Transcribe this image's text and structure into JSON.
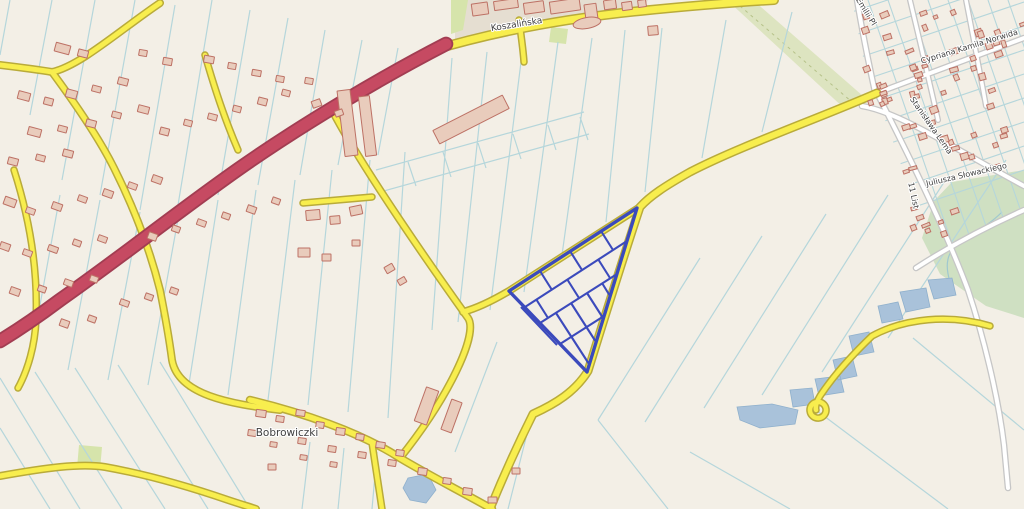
{
  "map": {
    "width": 1024,
    "height": 509,
    "colors": {
      "background": "#f3efe6",
      "field_line": "#b5d6db",
      "urban_fill": "#e5ded1",
      "building_fill": "#e9ccbc",
      "building_stroke": "#bd7165",
      "water_fill": "#a9c2da",
      "water_stroke": "#8fb0cc",
      "parcel_blue": "#3b4abc",
      "label_color": "#3f3f3f",
      "stream": "#9fc8cf",
      "tree_row_dash": "#b6c289"
    },
    "road_classes": {
      "white": {
        "casing": "#c6c6c6",
        "fill": "#ffffff",
        "extra": 2.6
      },
      "yellow": {
        "casing": "#b9ab3a",
        "fill": "#f8ee4e",
        "extra": 3.0
      },
      "red": {
        "casing": "#a23d52",
        "fill": "#c64a62",
        "extra": 3.6
      }
    },
    "labels": [
      {
        "name": "street-label-koszalinska",
        "text": "Koszalińska",
        "x": 517,
        "y": 27,
        "rot": -9,
        "size": 9
      },
      {
        "name": "place-label-bobrowiczki",
        "text": "Bobrowiczki",
        "x": 287,
        "y": 436,
        "rot": 0,
        "size": 10.5
      },
      {
        "name": "street-label-norwida",
        "text": "Cypriana Kamila Norwida",
        "x": 970,
        "y": 49,
        "rot": -17,
        "size": 8
      },
      {
        "name": "street-label-lema",
        "text": "Stanisława Lema",
        "x": 929,
        "y": 127,
        "rot": 55,
        "size": 8
      },
      {
        "name": "street-label-11-listopada",
        "text": "11 List",
        "x": 911,
        "y": 196,
        "rot": 78,
        "size": 8
      },
      {
        "name": "street-label-slowackiego",
        "text": "Juliusza Słowackiego",
        "x": 967,
        "y": 177,
        "rot": -13,
        "size": 8
      },
      {
        "name": "street-label-emilii",
        "text": "Emilii Pl",
        "x": 864,
        "y": 13,
        "rot": 58,
        "size": 8
      }
    ],
    "areas": [
      {
        "name": "urban-block",
        "fill": "#e5ded1",
        "d": "M 455,42 L 455,0 L 648,0 L 642,12 L 540,27 Z"
      },
      {
        "name": "tree-band",
        "fill": "#dde4c0",
        "d": "M 727,0 L 753,0 L 863,96 L 846,110 Z"
      },
      {
        "name": "meadow-large",
        "fill": "#cfe0c2",
        "d": "M 952,182 L 1024,170 L 1024,318 L 986,306 L 940,274 L 922,238 L 934,201 Z"
      },
      {
        "name": "green-strip-a",
        "fill": "#d6e4ab",
        "d": "M 451,0 L 468,0 L 463,30 L 451,34 Z"
      },
      {
        "name": "green-patch-b",
        "fill": "#d6e4ab",
        "d": "M 551,27 L 568,29 L 566,44 L 549,42 Z"
      },
      {
        "name": "green-patch-c",
        "fill": "#d6e4ab",
        "d": "M 79,445 L 102,447 L 100,470 L 77,468 Z"
      }
    ],
    "tree_row_dash_d": "M 740,6 L 852,102",
    "stream_d": "M 1002,212 C 982,232 962,236 952,250 C 945,260 947,272 950,282",
    "field_lines": [
      "M 10,0 L 0,55",
      "M 52,0 L 30,115",
      "M 95,0 L 62,180",
      "M 135,0 L 100,195",
      "M 175,5 L 140,210",
      "M 212,0 L 178,205",
      "M 250,10 L 218,195",
      "M 288,18 L 258,185",
      "M 325,30 L 300,175",
      "M 362,40 L 338,165",
      "M 398,48 L 378,155",
      "M 60,195 L 30,360",
      "M 100,200 L 68,370",
      "M 140,212 L 108,380",
      "M 180,208 L 148,385",
      "M 218,200 L 188,390",
      "M 256,190 L 228,395",
      "M 295,180 L 268,400",
      "M 332,170 L 308,405",
      "M 370,160 L 348,412",
      "M 405,152 L 388,418",
      "M 0,378 L 80,509",
      "M 0,428 L 50,509",
      "M 35,372 L 122,509",
      "M 75,368 L 165,509",
      "M 118,365 L 208,509",
      "M 160,362 L 250,509",
      "M 452,58 L 432,330",
      "M 487,52 L 458,322",
      "M 523,46 L 490,310",
      "M 558,42 L 524,292",
      "M 592,38 L 562,255",
      "M 625,30 L 606,222",
      "M 376,170 L 584,112",
      "M 380,192 L 589,134",
      "M 408,162 L 416,186",
      "M 443,152 L 451,177",
      "M 478,143 L 486,168",
      "M 513,134 L 521,159",
      "M 548,125 L 556,150",
      "M 580,117 L 588,140",
      "M 662,28 L 645,192",
      "M 726,20 L 702,158",
      "M 792,12 L 762,132",
      "M 700,258 L 598,420",
      "M 762,236 L 645,422",
      "M 826,214 L 704,408",
      "M 888,195 L 762,395",
      "M 948,176 L 822,372",
      "M 1006,160 L 888,338",
      "M 913,338 L 1024,430",
      "M 800,398 L 948,509",
      "M 690,452 L 790,509",
      "M 598,420 L 668,509",
      "M 497,342 L 455,452",
      "M 528,430 L 508,509",
      "M 310,442 L 302,509",
      "M 344,448 L 338,509",
      "M 377,452 L 372,509"
    ],
    "residential_grid": {
      "clip": "M 852,0 L 1024,0 L 1024,205 L 934,262 L 896,150 L 864,62 Z",
      "lines": [
        "M 852,12 L 1024,-46",
        "M 852,36 L 1024,-22",
        "M 852,60 L 1024,2",
        "M 852,84 L 1024,26",
        "M 852,108 L 1024,50",
        "M 852,132 L 1024,74",
        "M 852,156 L 1024,98",
        "M 852,180 L 1024,122",
        "M 852,204 L 1024,146",
        "M 852,228 L 1024,170",
        "M 868,0 L 956,255",
        "M 888,0 L 976,255",
        "M 908,0 L 996,255",
        "M 928,0 L 1016,255",
        "M 948,0 L 1036,255",
        "M 968,0 L 1056,255",
        "M 988,0 L 1076,255",
        "M 1008,0 L 1096,255"
      ]
    },
    "water": [
      "M 928,280 L 952,278 L 956,295 L 934,299 Z",
      "M 900,292 L 926,288 L 930,307 L 906,312 Z",
      "M 878,306 L 898,302 L 903,319 L 882,323 Z",
      "M 849,336 L 869,332 L 874,352 L 854,356 Z",
      "M 833,360 L 852,356 L 857,376 L 838,380 Z",
      "M 815,379 L 840,376 L 844,392 L 819,396 Z",
      "M 790,390 L 812,388 L 815,404 L 793,407 Z",
      "M 737,407 L 772,404 L 798,410 L 795,424 L 760,428 L 740,420 Z",
      "M 408,478 L 428,474 L 436,490 L 426,503 L 410,500 L 403,488 Z"
    ],
    "roads": [
      {
        "name": "street-emilii-road",
        "cls": "white",
        "w": 4,
        "d": "M 857,0 C 862,30 868,60 875,92"
      },
      {
        "name": "street-11-listopada-road",
        "cls": "white",
        "w": 4,
        "d": "M 877,93 C 905,148 945,228 968,290 C 983,335 998,395 1004,445 L 1008,488"
      },
      {
        "name": "street-norwida-road",
        "cls": "white",
        "w": 4,
        "d": "M 877,93 L 1024,38"
      },
      {
        "name": "street-upper-diagonal",
        "cls": "white",
        "w": 4,
        "d": "M 862,106 C 900,112 960,152 1024,186"
      },
      {
        "name": "street-slowackiego-road",
        "cls": "white",
        "w": 4,
        "d": "M 916,268 C 950,246 988,226 1024,210"
      },
      {
        "name": "street-grid-a",
        "cls": "white",
        "w": 3.5,
        "d": "M 910,0 C 920,42 930,84 938,120"
      },
      {
        "name": "street-grid-b",
        "cls": "white",
        "w": 3.5,
        "d": "M 966,0 C 973,36 980,72 986,106"
      },
      {
        "name": "road-koszalinska",
        "cls": "yellow",
        "w": 7,
        "d": "M 430,51 C 490,33 560,19 640,11 C 690,6 740,2 774,0"
      },
      {
        "name": "road-main-east",
        "cls": "yellow",
        "w": 6,
        "d": "M 877,93 C 820,118 740,146 690,172 C 665,186 650,196 640,207 C 628,243 610,300 588,371 C 575,392 555,404 533,414 C 520,440 505,472 490,509"
      },
      {
        "name": "road-parcel-northwest",
        "cls": "yellow",
        "w": 5,
        "d": "M 640,207 L 509,291 C 492,301 478,308 463,312"
      },
      {
        "name": "road-center-diagonal",
        "cls": "yellow",
        "w": 5,
        "d": "M 332,110 C 362,168 435,272 468,318 C 479,334 448,398 400,458"
      },
      {
        "name": "road-bobrowiczki",
        "cls": "yellow",
        "w": 5.5,
        "d": "M 250,400 C 300,412 360,432 400,458 C 425,473 458,490 492,509"
      },
      {
        "name": "road-southwest",
        "cls": "yellow",
        "w": 5,
        "d": "M 0,476 C 45,468 80,463 105,467 C 150,475 190,487 228,500 C 240,504 250,507 256,509"
      },
      {
        "name": "road-northwest-fork",
        "cls": "yellow",
        "w": 5,
        "d": "M 0,65 C 25,68 40,70 52,72 C 80,66 120,30 160,3"
      },
      {
        "name": "road-village-vertical",
        "cls": "yellow",
        "w": 5,
        "d": "M 52,72 C 80,110 100,140 114,168 C 135,210 150,250 160,290 C 166,320 170,345 172,360 C 178,395 230,404 280,410"
      },
      {
        "name": "road-far-west",
        "cls": "yellow",
        "w": 4.5,
        "d": "M 14,170 C 30,220 38,270 36,320 C 35,345 28,370 18,388"
      },
      {
        "name": "road-spur",
        "cls": "yellow",
        "w": 4.5,
        "d": "M 303,203 L 372,197"
      },
      {
        "name": "road-small-north",
        "cls": "yellow",
        "w": 4.5,
        "d": "M 205,55 C 215,90 225,120 238,150"
      },
      {
        "name": "road-bottom-stub",
        "cls": "yellow",
        "w": 4.5,
        "d": "M 372,443 L 382,509"
      },
      {
        "name": "road-koszalinska-stub",
        "cls": "yellow",
        "w": 4.5,
        "d": "M 519,20 C 521,35 523,48 524,62"
      },
      {
        "name": "road-pond-lane",
        "cls": "yellow",
        "w": 4.5,
        "d": "M 990,326 C 950,314 905,318 872,336 C 850,357 832,378 820,396 C 817,401 815,406 816,410 M 826,409 a 8,8 0 1,1 -16,2 a 8,8 0 1,1 16,-2"
      },
      {
        "name": "road-trunk",
        "cls": "red",
        "w": 11,
        "d": "M 446,44 C 380,78 300,126 240,168 C 180,210 120,258 60,300 C 40,315 18,330 0,341"
      }
    ],
    "buildings": {
      "rects": [
        [
          472,
          3,
          16,
          12,
          -8
        ],
        [
          494,
          0,
          24,
          9,
          -8
        ],
        [
          524,
          2,
          20,
          11,
          -8
        ],
        [
          550,
          0,
          30,
          12,
          -8
        ],
        [
          585,
          4,
          12,
          16,
          -8
        ],
        [
          604,
          0,
          12,
          9,
          -8
        ],
        [
          622,
          2,
          10,
          8,
          -8
        ],
        [
          638,
          0,
          8,
          7,
          -8
        ],
        [
          648,
          26,
          10,
          9,
          -5
        ],
        [
          341,
          90,
          13,
          66,
          -7
        ],
        [
          362,
          96,
          11,
          60,
          -7
        ],
        [
          432,
          112,
          78,
          15,
          -27
        ],
        [
          306,
          210,
          14,
          10,
          -5
        ],
        [
          330,
          216,
          10,
          8,
          -5
        ],
        [
          350,
          206,
          12,
          9,
          -12
        ],
        [
          298,
          248,
          12,
          9,
          0
        ],
        [
          322,
          254,
          9,
          7,
          0
        ],
        [
          352,
          240,
          8,
          6,
          0
        ],
        [
          385,
          265,
          9,
          7,
          -30
        ],
        [
          398,
          278,
          8,
          6,
          -30
        ],
        [
          55,
          44,
          15,
          9,
          15
        ],
        [
          78,
          50,
          10,
          7,
          15
        ],
        [
          18,
          92,
          12,
          8,
          15
        ],
        [
          44,
          98,
          9,
          7,
          15
        ],
        [
          66,
          90,
          11,
          8,
          15
        ],
        [
          92,
          86,
          9,
          6,
          15
        ],
        [
          118,
          78,
          10,
          7,
          15
        ],
        [
          28,
          128,
          13,
          8,
          15
        ],
        [
          58,
          126,
          9,
          6,
          15
        ],
        [
          86,
          120,
          10,
          7,
          15
        ],
        [
          112,
          112,
          9,
          6,
          15
        ],
        [
          138,
          106,
          11,
          7,
          15
        ],
        [
          8,
          158,
          10,
          7,
          15
        ],
        [
          36,
          155,
          9,
          6,
          15
        ],
        [
          63,
          150,
          10,
          7,
          15
        ],
        [
          160,
          128,
          9,
          7,
          15
        ],
        [
          184,
          120,
          8,
          6,
          15
        ],
        [
          208,
          114,
          9,
          6,
          15
        ],
        [
          233,
          106,
          8,
          6,
          15
        ],
        [
          258,
          98,
          9,
          7,
          15
        ],
        [
          282,
          90,
          8,
          6,
          15
        ],
        [
          204,
          56,
          10,
          7,
          10
        ],
        [
          228,
          63,
          8,
          6,
          10
        ],
        [
          252,
          70,
          9,
          6,
          10
        ],
        [
          276,
          76,
          8,
          6,
          10
        ],
        [
          163,
          58,
          9,
          7,
          10
        ],
        [
          139,
          50,
          8,
          6,
          10
        ],
        [
          305,
          78,
          8,
          6,
          10
        ],
        [
          312,
          100,
          9,
          7,
          -20
        ],
        [
          335,
          110,
          8,
          6,
          -20
        ],
        [
          4,
          198,
          12,
          8,
          20
        ],
        [
          26,
          208,
          9,
          6,
          20
        ],
        [
          52,
          203,
          10,
          7,
          20
        ],
        [
          78,
          196,
          9,
          6,
          20
        ],
        [
          103,
          190,
          10,
          7,
          20
        ],
        [
          128,
          183,
          9,
          6,
          20
        ],
        [
          152,
          176,
          10,
          7,
          20
        ],
        [
          0,
          243,
          10,
          7,
          20
        ],
        [
          23,
          250,
          9,
          6,
          20
        ],
        [
          48,
          246,
          10,
          6,
          20
        ],
        [
          73,
          240,
          8,
          6,
          20
        ],
        [
          98,
          236,
          9,
          6,
          20
        ],
        [
          10,
          288,
          10,
          7,
          20
        ],
        [
          38,
          286,
          8,
          6,
          20
        ],
        [
          64,
          280,
          9,
          6,
          20
        ],
        [
          90,
          276,
          8,
          6,
          20
        ],
        [
          148,
          233,
          9,
          7,
          20
        ],
        [
          172,
          226,
          8,
          6,
          20
        ],
        [
          197,
          220,
          9,
          6,
          20
        ],
        [
          222,
          213,
          8,
          6,
          20
        ],
        [
          247,
          206,
          9,
          7,
          20
        ],
        [
          272,
          198,
          8,
          6,
          20
        ],
        [
          120,
          300,
          9,
          6,
          20
        ],
        [
          145,
          294,
          8,
          6,
          20
        ],
        [
          170,
          288,
          8,
          6,
          20
        ],
        [
          60,
          320,
          9,
          7,
          20
        ],
        [
          88,
          316,
          8,
          6,
          20
        ],
        [
          256,
          410,
          10,
          7,
          8
        ],
        [
          276,
          416,
          8,
          6,
          8
        ],
        [
          296,
          410,
          9,
          6,
          8
        ],
        [
          316,
          422,
          8,
          6,
          8
        ],
        [
          336,
          428,
          9,
          7,
          8
        ],
        [
          356,
          434,
          8,
          6,
          8
        ],
        [
          376,
          442,
          9,
          6,
          8
        ],
        [
          396,
          450,
          8,
          6,
          8
        ],
        [
          298,
          438,
          8,
          6,
          8
        ],
        [
          328,
          446,
          8,
          6,
          8
        ],
        [
          358,
          452,
          8,
          6,
          8
        ],
        [
          388,
          460,
          8,
          6,
          8
        ],
        [
          418,
          468,
          9,
          7,
          8
        ],
        [
          443,
          478,
          8,
          6,
          8
        ],
        [
          463,
          488,
          9,
          7,
          8
        ],
        [
          248,
          430,
          8,
          6,
          8
        ],
        [
          270,
          442,
          7,
          5,
          8
        ],
        [
          300,
          455,
          7,
          5,
          8
        ],
        [
          330,
          462,
          7,
          5,
          8
        ],
        [
          420,
          388,
          13,
          36,
          20
        ],
        [
          446,
          400,
          11,
          32,
          20
        ],
        [
          488,
          497,
          9,
          6,
          0
        ],
        [
          512,
          468,
          8,
          6,
          0
        ],
        [
          268,
          464,
          8,
          6,
          0
        ]
      ],
      "ellipses": [
        {
          "cx": 587,
          "cy": 23,
          "rx": 14,
          "ry": 5.5,
          "rot": -10
        }
      ],
      "clusters": [
        {
          "x": 862,
          "y": 4,
          "w": 158,
          "h": 104,
          "count": 46,
          "rot": -19,
          "seed": 3
        },
        {
          "x": 900,
          "y": 116,
          "w": 112,
          "h": 56,
          "count": 16,
          "rot": -19,
          "seed": 5
        },
        {
          "x": 906,
          "y": 184,
          "w": 56,
          "h": 48,
          "count": 8,
          "rot": -19,
          "seed": 9
        }
      ]
    },
    "parcel_block": {
      "outer": "M 637,208 L 509,291 L 587,372 Z",
      "inner": [
        "M 627,241 L 525,307",
        "M 617,274 L 540,323",
        "M 601,231 L 613,250",
        "M 570,251 L 582,270",
        "M 540,271 L 552,290",
        "M 598,259 L 610,278",
        "M 567,279 L 579,298",
        "M 536,299 L 548,318",
        "M 602,283 L 610,296",
        "M 587,293 L 603,318",
        "M 571,303 L 596,342",
        "M 556,313 L 589,364",
        "M 560,344 L 604,316",
        "M 521,307 L 557,345"
      ]
    }
  }
}
